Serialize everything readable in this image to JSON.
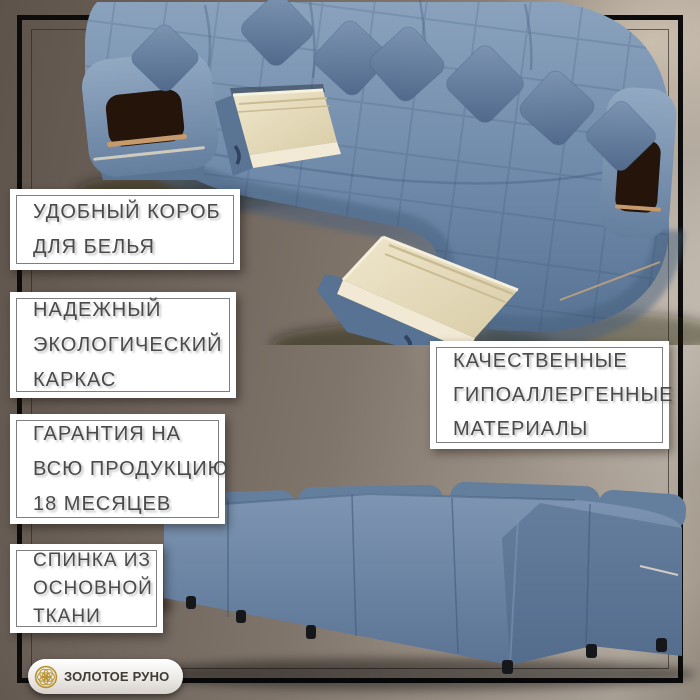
{
  "canvas": {
    "width": 700,
    "height": 700
  },
  "colors": {
    "background_dark": "#5d534a",
    "background_light": "#b2a99e",
    "frame_border": "#0c0c0c",
    "callout_background": "#ffffff",
    "callout_border": "#7e7e7e",
    "callout_text": "#4a4a4a",
    "sofa_fabric_light": "#8aa2bd",
    "sofa_fabric": "#6e89a9",
    "sofa_fabric_dark": "#4e6687",
    "drawer_wood": "#ece3c8",
    "niche_wood": "#c79a6b",
    "logo_gold": "#b8922f",
    "logo_text_color": "#3f3b37"
  },
  "photos": {
    "top": {
      "name": "u-shaped-sofa-with-open-storage-drawers"
    },
    "bottom": {
      "name": "sofa-back-upholstered-view"
    }
  },
  "callouts": [
    {
      "lines": [
        "УДОБНЫЙ КОРОБ",
        "ДЛЯ БЕЛЬЯ"
      ]
    },
    {
      "lines": [
        "НАДЕЖНЫЙ",
        "ЭКОЛОГИЧЕСКИЙ",
        "КАРКАС"
      ]
    },
    {
      "lines": [
        "ГАРАНТИЯ НА",
        "ВСЮ ПРОДУКЦИЮ",
        "18 МЕСЯЦЕВ"
      ]
    },
    {
      "lines": [
        "СПИНКА ИЗ",
        "ОСНОВНОЙ",
        "ТКАНИ"
      ]
    },
    {
      "lines": [
        "КАЧЕСТВЕННЫЕ",
        "ГИПОАЛЛЕРГЕННЫЕ",
        "МАТЕРИАЛЫ"
      ]
    }
  ],
  "logo": {
    "text": "ЗОЛОТОЕ РУНО"
  }
}
